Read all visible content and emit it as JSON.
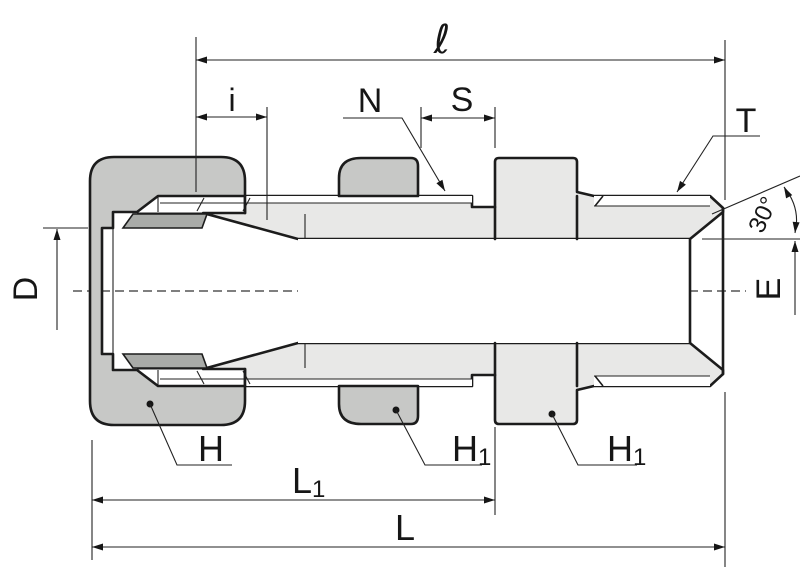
{
  "drawing": {
    "labels": {
      "ell": "ℓ",
      "i": "i",
      "n": "N",
      "s": "S",
      "t": "T",
      "angle": "30°",
      "d": "D",
      "e": "E",
      "h": "H",
      "h1_locknut": {
        "main": "H",
        "sub": "1"
      },
      "h1_hex": {
        "main": "H",
        "sub": "1"
      },
      "l1": {
        "main": "L",
        "sub": "1"
      },
      "l": "L"
    },
    "colors": {
      "background": "#ffffff",
      "body_fill": "#e8e8e7",
      "nut_fill": "#c7c8c6",
      "ferrule_fill": "#a9aba8",
      "line": "#1c1c1c"
    }
  }
}
